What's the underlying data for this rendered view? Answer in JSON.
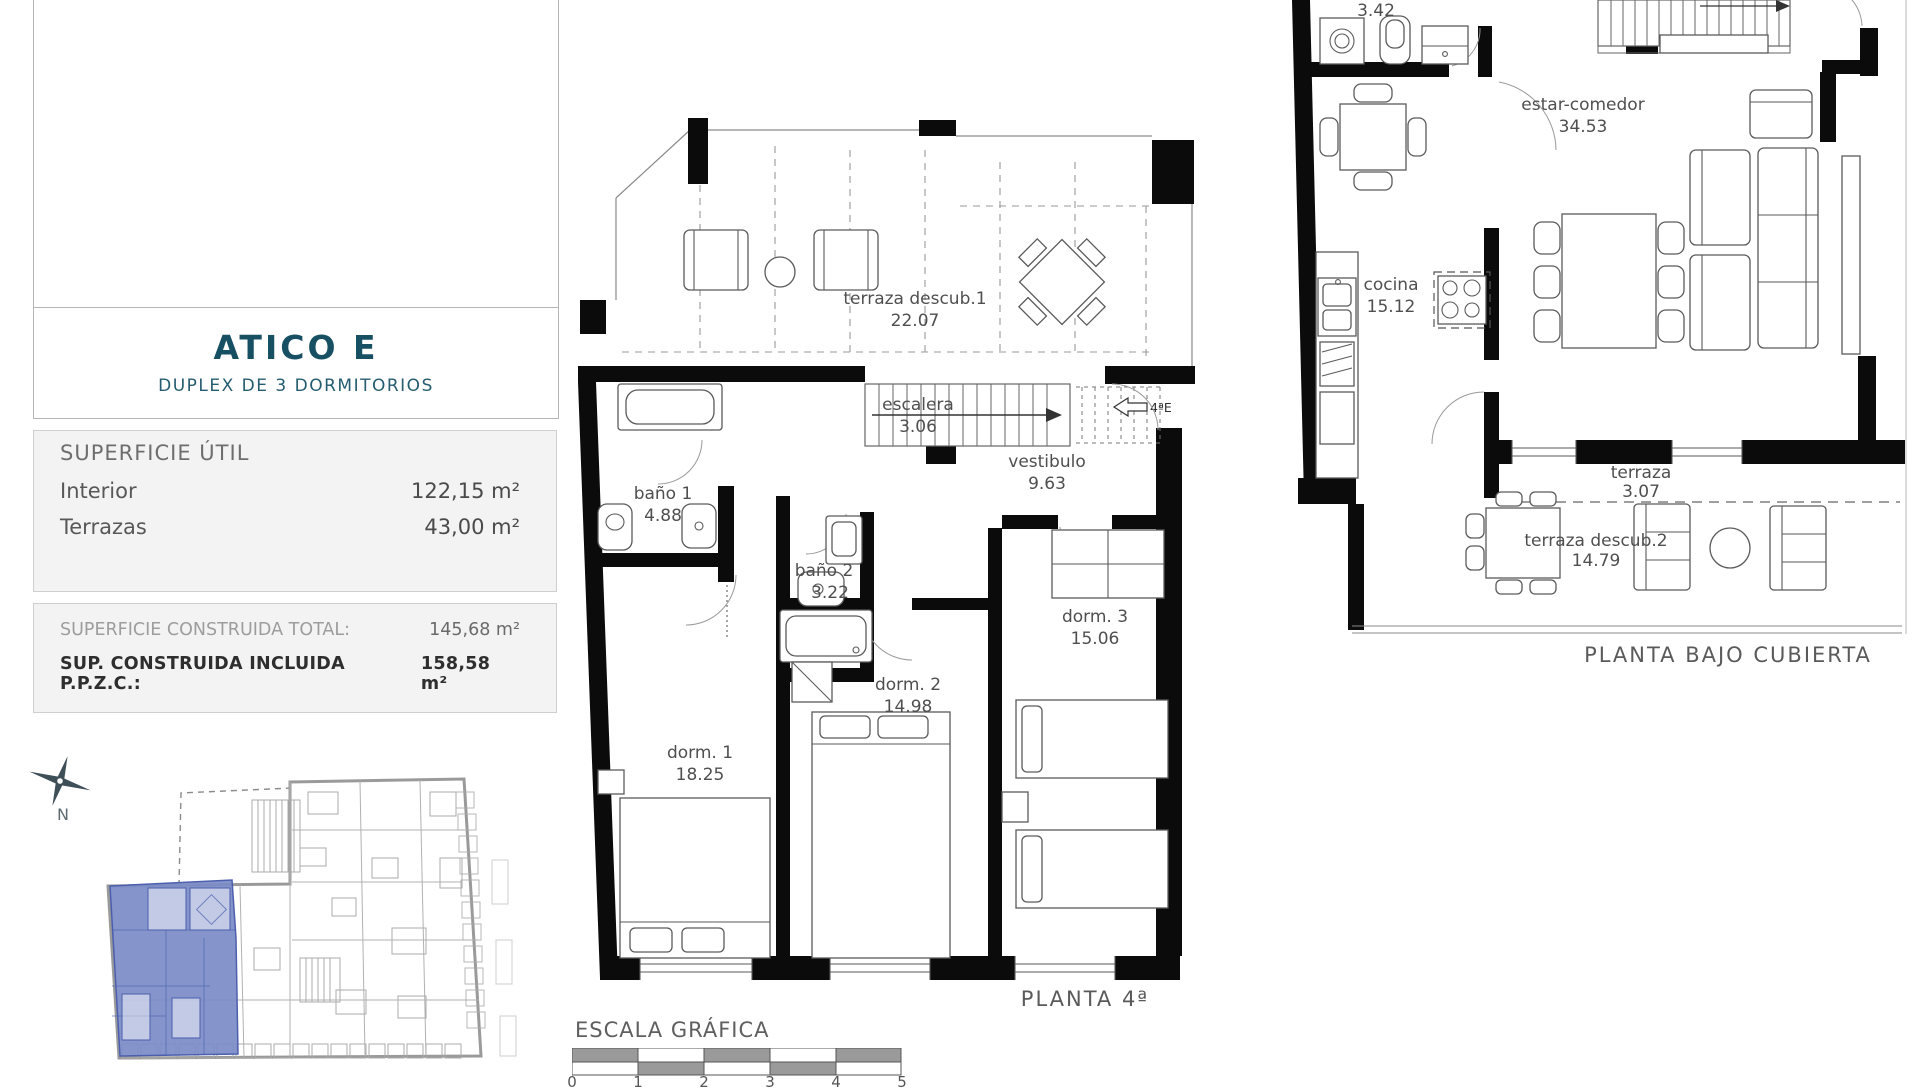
{
  "colors": {
    "accent_teal": "#174f63",
    "panel_bg": "#f3f3f3",
    "panel_border": "#cfcfcf",
    "plan_gray": "#9a9a9a",
    "highlight_blue": "#7b8cc7"
  },
  "unit": {
    "title": "ATICO E",
    "subtitle": "DUPLEX DE 3 DORMITORIOS"
  },
  "superficie_util": {
    "heading": "SUPERFICIE ÚTIL",
    "rows": [
      {
        "label": "Interior",
        "value": "122,15 m²"
      },
      {
        "label": "Terrazas",
        "value": "43,00 m²"
      }
    ]
  },
  "superficie_construida": {
    "rows": [
      {
        "label": "SUPERFICIE CONSTRUIDA TOTAL:",
        "value": "145,68 m²"
      },
      {
        "label": "SUP. CONSTRUIDA INCLUIDA P.P.Z.C.:",
        "value": "158,58 m²"
      }
    ]
  },
  "compass": {
    "north_label": "N"
  },
  "planta4": {
    "caption": "PLANTA 4ª",
    "entry_label": "4ªE",
    "rooms": {
      "terraza1": {
        "name": "terraza descub.1",
        "area": "22.07"
      },
      "escalera": {
        "name": "escalera",
        "area": "3.06"
      },
      "vestibulo": {
        "name": "vestibulo",
        "area": "9.63"
      },
      "bano1": {
        "name": "baño 1",
        "area": "4.88"
      },
      "bano2": {
        "name": "baño 2",
        "area": "3.22"
      },
      "dorm1": {
        "name": "dorm. 1",
        "area": "18.25"
      },
      "dorm2": {
        "name": "dorm. 2",
        "area": "14.98"
      },
      "dorm3": {
        "name": "dorm. 3",
        "area": "15.06"
      }
    }
  },
  "planta_bajo_cubierta": {
    "caption": "PLANTA BAJO CUBIERTA",
    "rooms": {
      "bano3": {
        "area": "3.42"
      },
      "estar": {
        "name": "estar-comedor",
        "area": "34.53"
      },
      "cocina": {
        "name": "cocina",
        "area": "15.12"
      },
      "terraza": {
        "name": "terraza",
        "area": "3.07"
      },
      "terraza2": {
        "name": "terraza descub.2",
        "area": "14.79"
      }
    }
  },
  "escala": {
    "title": "ESCALA GRÁFICA",
    "ticks": [
      "0",
      "1",
      "2",
      "3",
      "4",
      "5"
    ]
  }
}
